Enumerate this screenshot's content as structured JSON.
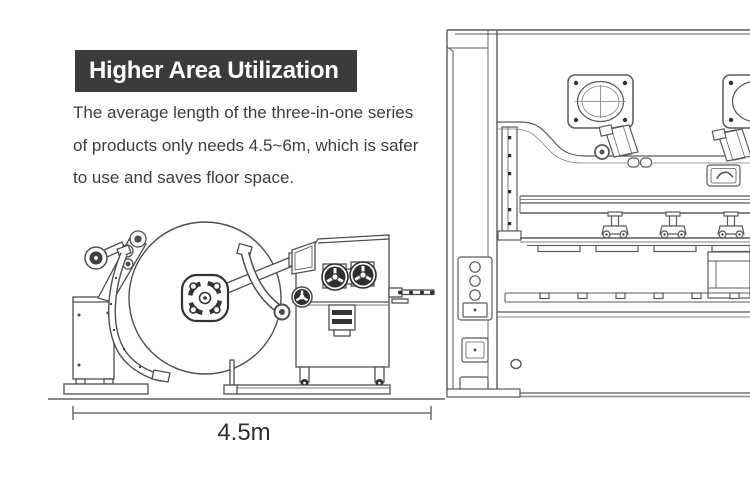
{
  "header": {
    "title": "Higher Area Utilization"
  },
  "description": {
    "lines": [
      "The average length of the three-in-one series",
      "of products only needs 4.5~6m, which is safer",
      "to use and saves floor space."
    ]
  },
  "diagram": {
    "dimension_label": "4.5m",
    "left_machine": "three-in-one decoiler-straightener-feeder line drawing",
    "right_machine": "stamping press line drawing (partially cropped at right edge)"
  },
  "colors": {
    "banner_background": "#3b3b3b",
    "title_text": "#ffffff",
    "body_text": "#3d3d3d",
    "line_art": "#5a5a5a",
    "dark_parts": "#2f2f2f"
  }
}
